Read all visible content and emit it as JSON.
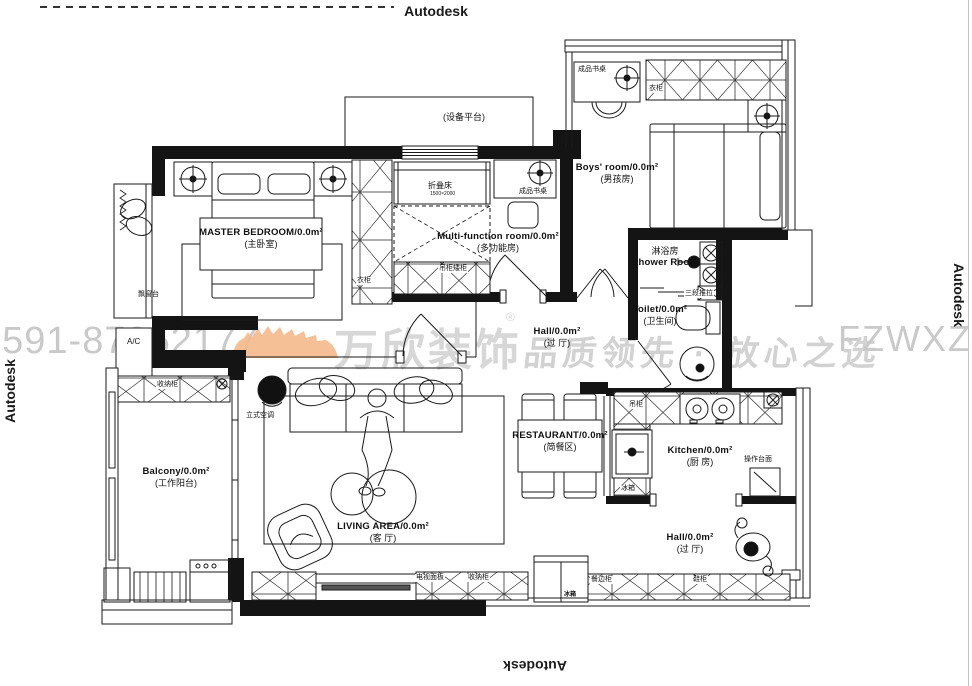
{
  "watermarks": {
    "autodesk": "Autodesk",
    "phone": "0591-87952177",
    "brand_name": "万欣装饰",
    "brand_reg": "®",
    "slogan": "品质领先 · 放心之选",
    "website": "FZWXZS.CO"
  },
  "rooms": {
    "master_bedroom": {
      "en": "MASTER BEDROOM/0.0m²",
      "cn": "(主卧室)"
    },
    "multi_function_room": {
      "en": "Multi-function room/0.0m²",
      "cn": "(多功能房)"
    },
    "boys_room": {
      "en": "Boys' room/0.0m²",
      "cn": "(男孩房)"
    },
    "shower_room": {
      "cn": "淋浴房",
      "en": "Shower Room"
    },
    "toilet": {
      "en": "Toilet/0.0m²",
      "cn": "(卫生间)"
    },
    "hall": {
      "en": "Hall/0.0m²",
      "cn": "(过 厅)"
    },
    "restaurant": {
      "en": "RESTAURANT/0.0m²",
      "cn": "(简餐区)"
    },
    "kitchen": {
      "en": "Kitchen/0.0m²",
      "cn": "(厨 房)"
    },
    "hall_entry": {
      "en": "Hall/0.0m²",
      "cn": "(过 厅)"
    },
    "living_area": {
      "en": "LIVING AREA/0.0m²",
      "cn": "(客 厅)"
    },
    "balcony": {
      "en": "Balcony/0.0m²",
      "cn": "(工作阳台)"
    },
    "equipment_platform": {
      "cn": "(设备平台)"
    }
  },
  "fixtures": {
    "bay_window": "飘窗台",
    "ac_platform": "A/C",
    "standing_ac": "立式空调",
    "wardrobe_master": "衣柜",
    "wardrobe_boys": "衣柜",
    "folding_bed": "折叠床",
    "folding_bed_size": "1500×2000",
    "desk_multi": "成品书桌",
    "desk_boys": "成品书桌",
    "low_cabinet": "吊柜矮柜",
    "sliding_door": "三段推拉",
    "hanging_cabinet": "吊柜",
    "fridge_kitchen": "冰箱",
    "fridge": "冰箱",
    "work_counter": "操作台面",
    "sideboard": "餐边柜",
    "shoe_cabinet": "鞋柜",
    "storage_balcony": "收纳柜",
    "tv_panel": "电视面板",
    "storage_tv": "收纳柜"
  },
  "colors": {
    "ink": "#1a1a1a",
    "wall": "#141414",
    "watermark_gray": "#cccccc",
    "brand_orange": "#f5b98c"
  }
}
